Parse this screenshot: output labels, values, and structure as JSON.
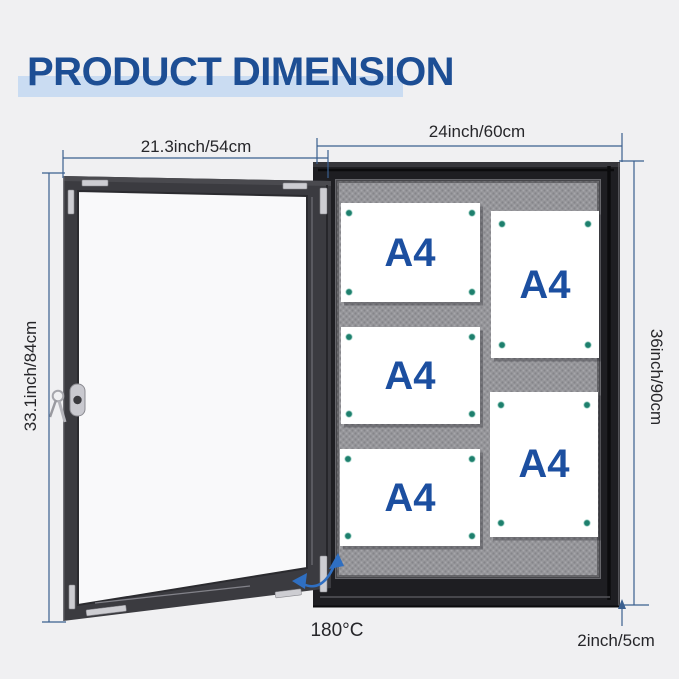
{
  "title": {
    "text": "PRODUCT DIMENSION"
  },
  "dimensions": {
    "door_width": {
      "label": "21.3inch/54cm"
    },
    "door_height": {
      "label": "33.1inch/84cm"
    },
    "board_width": {
      "label": "24inch/60cm"
    },
    "board_height": {
      "label": "36inch/90cm"
    },
    "board_depth": {
      "label": "2inch/5cm"
    },
    "door_swing_angle": {
      "label": "180°C"
    }
  },
  "board": {
    "papers": [
      {
        "label": "A4",
        "orientation": "landscape"
      },
      {
        "label": "A4",
        "orientation": "landscape"
      },
      {
        "label": "A4",
        "orientation": "landscape"
      },
      {
        "label": "A4",
        "orientation": "portrait"
      },
      {
        "label": "A4",
        "orientation": "portrait"
      }
    ]
  },
  "icons": {
    "lock": "lock-icon",
    "keys": "keys-icon",
    "push_pin": "push-pin-icon",
    "rotation_arrow": "rotation-arrow-icon"
  },
  "colors": {
    "background": "#f0f0f2",
    "title_blue": "#1d4e94",
    "highlight_blue": "#cadcf2",
    "dim_line": "#3a5f8f",
    "label_text": "#26262a",
    "paper_label": "#1c4fa0",
    "paper": "#ffffff",
    "pin": "#1e7f6d",
    "pin_ring": "#9fd4c6",
    "arrow_blue": "#2f6fc2",
    "door_frame": "#3b3b40",
    "glass": "#f9f9fa",
    "board_black": "#1e1e22",
    "fabric_base": "#97979b",
    "silver": "#cdcdd2"
  }
}
